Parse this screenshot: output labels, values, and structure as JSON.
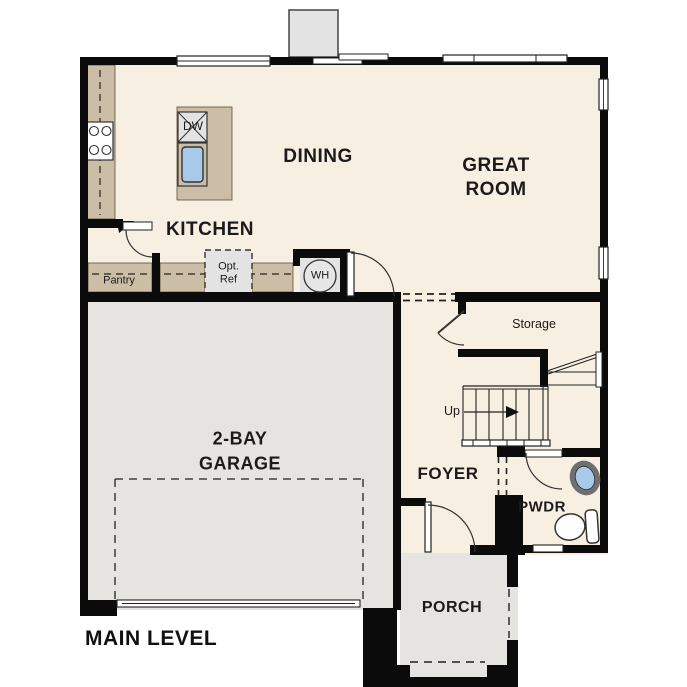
{
  "title": "MAIN LEVEL",
  "colors": {
    "floor_cream": "#f7efe1",
    "garage_gray": "#e5e4e1",
    "counter_tan": "#ccbea6",
    "fixture_gray": "#e3e3e3",
    "sink_blue": "#a9c9ea",
    "wall_black": "#0b0b0b",
    "text": "#1b1b1b"
  },
  "rooms": {
    "kitchen": "KITCHEN",
    "dining": "DINING",
    "great_room_line1": "GREAT",
    "great_room_line2": "ROOM",
    "garage_line1": "2-BAY",
    "garage_line2": "GARAGE",
    "foyer": "FOYER",
    "powder": "PWDR",
    "porch": "PORCH",
    "storage": "Storage",
    "pantry": "Pantry"
  },
  "annotations": {
    "up": "Up",
    "dishwasher": "DW",
    "water_heater": "WH",
    "opt_ref": "Opt.\nRef"
  }
}
